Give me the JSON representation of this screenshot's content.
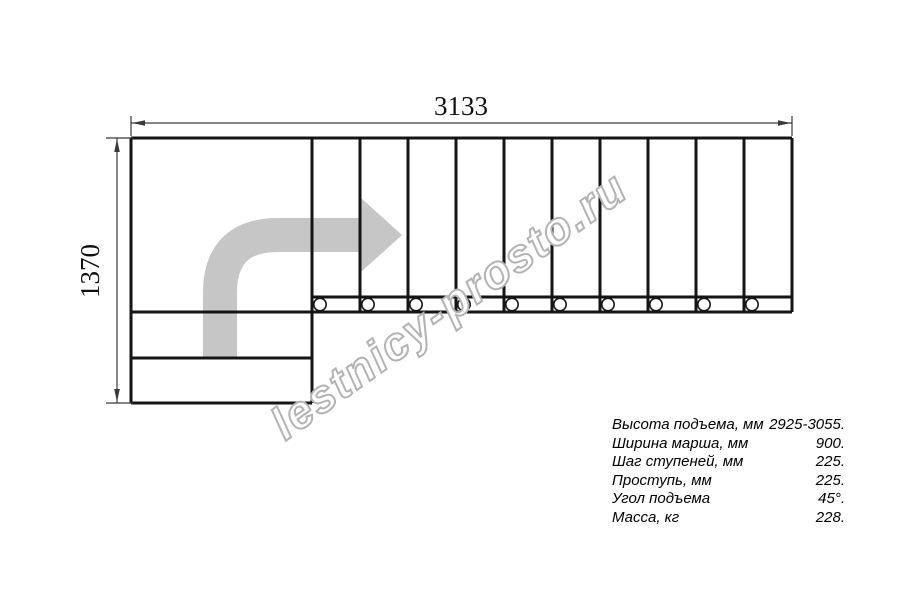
{
  "dimensions": {
    "width_label": "3133",
    "height_label": "1370"
  },
  "watermark": {
    "text": "lestnicy-prosto.ru"
  },
  "colors": {
    "drawing_line": "#151515",
    "dimension_line": "#3a3a3a",
    "arrow_fill": "#c6c6c6",
    "watermark_outline": "#b3b3b3"
  },
  "specs": {
    "rows": [
      {
        "label": "Высота подъема, мм",
        "value": "2925-3055."
      },
      {
        "label": "Ширина марша, мм",
        "value": "900."
      },
      {
        "label": "Шаг ступеней, мм",
        "value": "225."
      },
      {
        "label": "Проступь, мм",
        "value": "225."
      },
      {
        "label": "Угол подъема",
        "value": "45°."
      },
      {
        "label": "Масса, кг",
        "value": "228."
      }
    ]
  }
}
